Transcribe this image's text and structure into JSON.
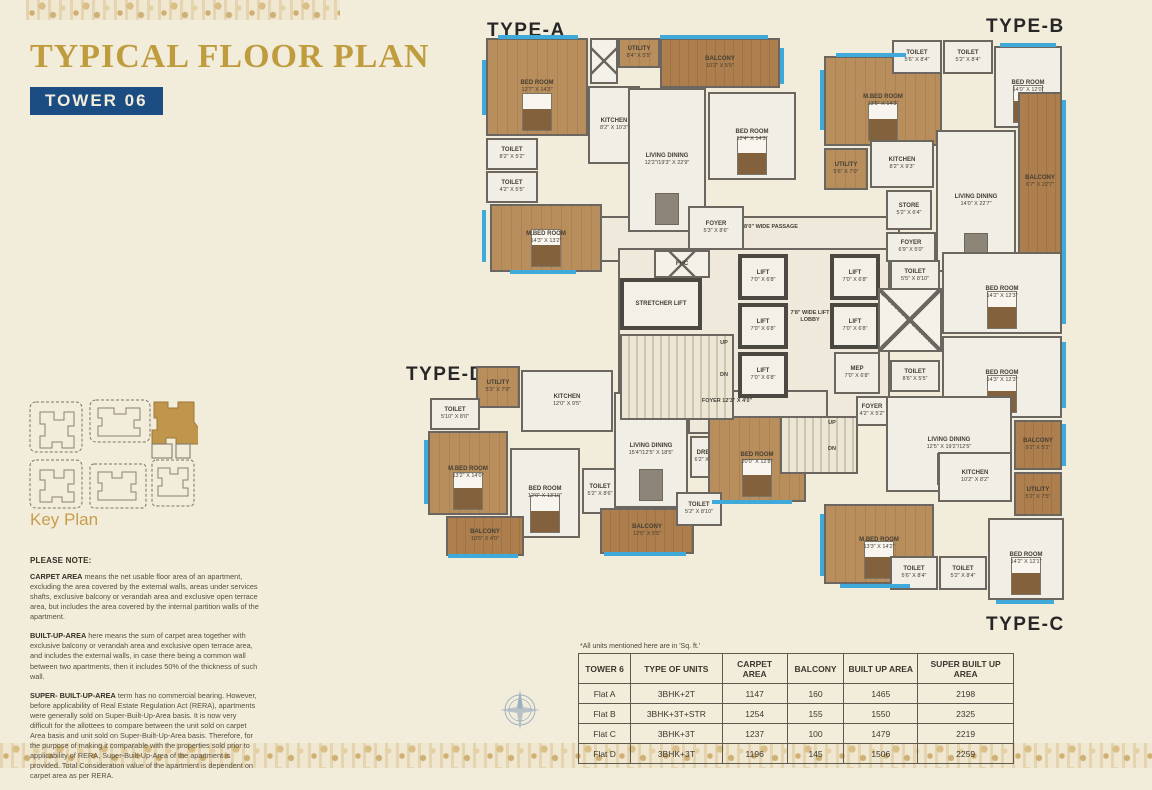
{
  "header": {
    "title": "TYPICAL FLOOR PLAN",
    "badge": "TOWER 06",
    "title_color": "#bf9c3e",
    "badge_bg": "#1c4d82"
  },
  "key_plan": {
    "label": "Key Plan",
    "highlight_color": "#c0954c"
  },
  "notes": {
    "heading": "PLEASE NOTE:",
    "paragraphs": [
      {
        "lead": "CARPET AREA",
        "text": " means the net usable floor area of an apartment, excluding the area covered by the external walls, areas under services shafts, exclusive balcony or verandah area and exclusive open terrace area, but includes the area covered by the internal partition walls of the apartment."
      },
      {
        "lead": "BUILT-UP-AREA",
        "text": " here means the sum of carpet area together with exclusive balcony or verandah area and exclusive open terrace area, and includes the external walls, in case there being a common wall between two apartments, then it includes 50% of the thickness of such wall."
      },
      {
        "lead": "SUPER- BUILT-UP-AREA",
        "text": " term has no commercial bearing. However, before applicability of Real Estate Regulation Act (RERA), apartments were generally sold on Super-Built-Up-Area basis. It is now very difficult for the allottees to compare between the unit sold on carpet Area basis and unit sold on Super-Built-Up-Area basis. Therefore, for the purpose of making it comparable with the properties sold prior to applicability of RERA, Super-Built-Up-Area of the apartment is provided. Total Consideration value of the apartment is dependent on carpet area as per RERA."
      }
    ]
  },
  "table": {
    "note": "*All units mentioned here are in 'Sq. ft.'",
    "headers": [
      "TOWER 6",
      "TYPE OF UNITS",
      "CARPET AREA",
      "BALCONY",
      "BUILT UP AREA",
      "SUPER BUILT UP AREA"
    ],
    "rows": [
      [
        "Flat A",
        "3BHK+2T",
        "1147",
        "160",
        "1465",
        "2198"
      ],
      [
        "Flat B",
        "3BHK+3T+STR",
        "1254",
        "155",
        "1550",
        "2325"
      ],
      [
        "Flat C",
        "3BHK+3T",
        "1237",
        "100",
        "1479",
        "2219"
      ],
      [
        "Flat D",
        "3BHK+3T",
        "1196",
        "145",
        "1506",
        "2259"
      ]
    ]
  },
  "floorplan": {
    "type_labels": [
      {
        "text": "TYPE-A",
        "x": 487,
        "y": 20
      },
      {
        "text": "TYPE-B",
        "x": 986,
        "y": 16
      },
      {
        "text": "TYPE-C",
        "x": 986,
        "y": 614
      },
      {
        "text": "TYPE-D",
        "x": 406,
        "y": 364
      }
    ],
    "rooms": [
      {
        "x": 600,
        "y": 216,
        "w": 300,
        "h": 46,
        "kind": "corr"
      },
      {
        "x": 618,
        "y": 248,
        "w": 272,
        "h": 176,
        "kind": "corr"
      },
      {
        "x": 688,
        "y": 390,
        "w": 140,
        "h": 44,
        "kind": "corr"
      },
      {
        "x": 486,
        "y": 38,
        "w": 102,
        "h": 98,
        "kind": "wood",
        "label": "BED ROOM",
        "size": "12'7\" X 14'3\"",
        "bed": 1
      },
      {
        "x": 590,
        "y": 38,
        "w": 28,
        "h": 46,
        "kind": "shaft"
      },
      {
        "x": 618,
        "y": 38,
        "w": 42,
        "h": 30,
        "kind": "wood",
        "label": "UTILITY",
        "size": "8'4\" X 5'5\""
      },
      {
        "x": 660,
        "y": 38,
        "w": 120,
        "h": 50,
        "kind": "balc",
        "label": "BALCONY",
        "size": "10'2\" X 5'5\""
      },
      {
        "x": 588,
        "y": 86,
        "w": 52,
        "h": 78,
        "kind": "tile",
        "label": "KITCHEN",
        "size": "8'2\" X 10'3\""
      },
      {
        "x": 486,
        "y": 138,
        "w": 52,
        "h": 32,
        "kind": "tile",
        "label": "TOILET",
        "size": "8'2\" X 5'2\""
      },
      {
        "x": 486,
        "y": 171,
        "w": 52,
        "h": 32,
        "kind": "tile",
        "label": "TOILET",
        "size": "4'2\" X 5'5\""
      },
      {
        "x": 490,
        "y": 204,
        "w": 112,
        "h": 68,
        "kind": "wood",
        "label": "M.BED ROOM",
        "size": "14'3\" X 13'2\"",
        "bed": 1
      },
      {
        "x": 628,
        "y": 88,
        "w": 78,
        "h": 144,
        "kind": "tile",
        "label": "LIVING DINING",
        "size": "12'2\"/19'3\" X 22'9\"",
        "dtable": 1
      },
      {
        "x": 708,
        "y": 92,
        "w": 88,
        "h": 88,
        "kind": "tile",
        "label": "BED ROOM",
        "size": "12'4\" X 14'3\"",
        "bed": 1
      },
      {
        "x": 688,
        "y": 206,
        "w": 56,
        "h": 44,
        "kind": "tile",
        "label": "FOYER",
        "size": "5'3\" X 8'6\""
      },
      {
        "x": 824,
        "y": 56,
        "w": 118,
        "h": 90,
        "kind": "wood",
        "label": "M.BED ROOM",
        "size": "13'5\" X 14'3\"",
        "bed": 1
      },
      {
        "x": 892,
        "y": 40,
        "w": 50,
        "h": 34,
        "kind": "tile",
        "label": "TOILET",
        "size": "5'6\" X 8'4\""
      },
      {
        "x": 943,
        "y": 40,
        "w": 50,
        "h": 34,
        "kind": "tile",
        "label": "TOILET",
        "size": "5'2\" X 8'4\""
      },
      {
        "x": 994,
        "y": 46,
        "w": 68,
        "h": 82,
        "kind": "tile",
        "label": "BED ROOM",
        "size": "14'0\" X 12'0\"",
        "bed": 1
      },
      {
        "x": 824,
        "y": 148,
        "w": 44,
        "h": 42,
        "kind": "wood",
        "label": "UTILITY",
        "size": "5'6\" X 7'0\""
      },
      {
        "x": 870,
        "y": 140,
        "w": 64,
        "h": 48,
        "kind": "tile",
        "label": "KITCHEN",
        "size": "8'2\" X 9'3\""
      },
      {
        "x": 936,
        "y": 130,
        "w": 80,
        "h": 142,
        "kind": "tile",
        "label": "LIVING DINING",
        "size": "14'0\" X 22'7\"",
        "dtable": 1
      },
      {
        "x": 886,
        "y": 190,
        "w": 46,
        "h": 40,
        "kind": "tile",
        "label": "STORE",
        "size": "5'2\" X 6'4\""
      },
      {
        "x": 1018,
        "y": 92,
        "w": 44,
        "h": 180,
        "kind": "balc",
        "label": "BALCONY",
        "size": "6'7\" X 22'7\""
      },
      {
        "x": 886,
        "y": 232,
        "w": 50,
        "h": 30,
        "kind": "tile",
        "label": "FOYER",
        "size": "6'9\" X 5'0\""
      },
      {
        "x": 890,
        "y": 260,
        "w": 50,
        "h": 32,
        "kind": "tile",
        "label": "TOILET",
        "size": "5'5\" X 8'10\""
      },
      {
        "x": 942,
        "y": 252,
        "w": 120,
        "h": 82,
        "kind": "tile",
        "label": "BED ROOM",
        "size": "14'2\" X 12'3\"",
        "bed": 1
      },
      {
        "x": 890,
        "y": 360,
        "w": 50,
        "h": 32,
        "kind": "tile",
        "label": "TOILET",
        "size": "8'6\" X 5'5\""
      },
      {
        "x": 942,
        "y": 336,
        "w": 120,
        "h": 82,
        "kind": "tile",
        "label": "BED ROOM",
        "size": "14'3\" X 12'3\"",
        "bed": 1
      },
      {
        "x": 1014,
        "y": 420,
        "w": 48,
        "h": 50,
        "kind": "balc",
        "label": "BALCONY",
        "size": "9'2\" X 5'2\""
      },
      {
        "x": 886,
        "y": 396,
        "w": 126,
        "h": 96,
        "kind": "tile",
        "label": "LIVING DINING",
        "size": "12'5\" X 19'2\"/12'5\"",
        "dtable": 1
      },
      {
        "x": 938,
        "y": 452,
        "w": 74,
        "h": 50,
        "kind": "tile",
        "label": "KITCHEN",
        "size": "10'2\" X 8'2\""
      },
      {
        "x": 1014,
        "y": 472,
        "w": 48,
        "h": 44,
        "kind": "balc",
        "label": "UTILITY",
        "size": "5'2\" X 7'5\""
      },
      {
        "x": 824,
        "y": 504,
        "w": 110,
        "h": 80,
        "kind": "wood",
        "label": "M.BED ROOM",
        "size": "13'3\" X 14'2\"",
        "bed": 1
      },
      {
        "x": 890,
        "y": 556,
        "w": 48,
        "h": 34,
        "kind": "tile",
        "label": "TOILET",
        "size": "5'6\" X 8'4\""
      },
      {
        "x": 939,
        "y": 556,
        "w": 48,
        "h": 34,
        "kind": "tile",
        "label": "TOILET",
        "size": "5'2\" X 8'4\""
      },
      {
        "x": 988,
        "y": 518,
        "w": 76,
        "h": 82,
        "kind": "tile",
        "label": "BED ROOM",
        "size": "14'2\" X 12'1\"",
        "bed": 1
      },
      {
        "x": 856,
        "y": 396,
        "w": 32,
        "h": 30,
        "kind": "tile",
        "label": "FOYER",
        "size": "4'2\" X 5'2\""
      },
      {
        "x": 476,
        "y": 366,
        "w": 44,
        "h": 42,
        "kind": "wood",
        "label": "UTILITY",
        "size": "5'3\" X 7'0\""
      },
      {
        "x": 521,
        "y": 370,
        "w": 92,
        "h": 62,
        "kind": "tile",
        "label": "KITCHEN",
        "size": "12'0\" X 9'5\""
      },
      {
        "x": 430,
        "y": 398,
        "w": 50,
        "h": 32,
        "kind": "tile",
        "label": "TOILET",
        "size": "5'10\" X 8'0\""
      },
      {
        "x": 428,
        "y": 431,
        "w": 80,
        "h": 84,
        "kind": "wood",
        "label": "M.BED ROOM",
        "size": "13'2\" X 14'0\"",
        "bed": 1
      },
      {
        "x": 510,
        "y": 448,
        "w": 70,
        "h": 90,
        "kind": "tile",
        "label": "BED ROOM",
        "size": "12'0\" X 13'10\"",
        "bed": 1
      },
      {
        "x": 582,
        "y": 468,
        "w": 36,
        "h": 46,
        "kind": "tile",
        "label": "TOILET",
        "size": "5'2\" X 8'6\""
      },
      {
        "x": 614,
        "y": 392,
        "w": 74,
        "h": 116,
        "kind": "tile",
        "label": "LIVING DINING",
        "size": "15'4\"/12'5\" X 18'5\"",
        "dtable": 1
      },
      {
        "x": 446,
        "y": 516,
        "w": 78,
        "h": 40,
        "kind": "balc",
        "label": "BALCONY",
        "size": "10'5\" X 4'0\""
      },
      {
        "x": 600,
        "y": 508,
        "w": 94,
        "h": 46,
        "kind": "balc",
        "label": "BALCONY",
        "size": "12'5\" X 5'5\""
      },
      {
        "x": 690,
        "y": 436,
        "w": 34,
        "h": 42,
        "kind": "tile",
        "label": "DRESS",
        "size": "6'2\" X 6'7\""
      },
      {
        "x": 708,
        "y": 416,
        "w": 98,
        "h": 86,
        "kind": "wood",
        "label": "BED ROOM",
        "size": "20'0\" X 12'8\"",
        "bed": 1
      },
      {
        "x": 676,
        "y": 492,
        "w": 46,
        "h": 34,
        "kind": "tile",
        "label": "TOILET",
        "size": "5'2\" X 8'10\""
      },
      {
        "x": 654,
        "y": 250,
        "w": 56,
        "h": 28,
        "kind": "shaft",
        "label": "FHC"
      },
      {
        "x": 620,
        "y": 278,
        "w": 82,
        "h": 52,
        "kind": "lift",
        "label": "STRETCHER LIFT"
      },
      {
        "x": 620,
        "y": 334,
        "w": 114,
        "h": 86,
        "kind": "stair"
      },
      {
        "x": 738,
        "y": 254,
        "w": 50,
        "h": 46,
        "kind": "lift",
        "label": "LIFT",
        "size": "7'0\" X 6'8\""
      },
      {
        "x": 738,
        "y": 303,
        "w": 50,
        "h": 46,
        "kind": "lift",
        "label": "LIFT",
        "size": "7'0\" X 6'8\""
      },
      {
        "x": 738,
        "y": 352,
        "w": 50,
        "h": 46,
        "kind": "lift",
        "label": "LIFT",
        "size": "7'0\" X 6'8\""
      },
      {
        "x": 830,
        "y": 254,
        "w": 50,
        "h": 46,
        "kind": "lift",
        "label": "LIFT",
        "size": "7'0\" X 6'8\""
      },
      {
        "x": 830,
        "y": 303,
        "w": 50,
        "h": 46,
        "kind": "lift",
        "label": "LIFT",
        "size": "7'0\" X 6'8\""
      },
      {
        "x": 834,
        "y": 352,
        "w": 46,
        "h": 42,
        "kind": "tile",
        "label": "MEP",
        "size": "7'0\" X 6'8\""
      },
      {
        "x": 878,
        "y": 288,
        "w": 64,
        "h": 64,
        "kind": "shaft"
      },
      {
        "x": 780,
        "y": 416,
        "w": 78,
        "h": 58,
        "kind": "stair"
      }
    ],
    "annotations": [
      {
        "text": "8'0\" WIDE PASSAGE",
        "x": 716,
        "y": 224,
        "w": 110
      },
      {
        "text": "7'8\" WIDE LIFT LOBBY",
        "x": 790,
        "y": 310,
        "w": 40
      },
      {
        "text": "FOYER 12'3\" X 4'0\"",
        "x": 692,
        "y": 398,
        "w": 70
      },
      {
        "text": "UP",
        "x": 716,
        "y": 340,
        "w": 16
      },
      {
        "text": "DN",
        "x": 716,
        "y": 372,
        "w": 16
      },
      {
        "text": "UP",
        "x": 824,
        "y": 420,
        "w": 16
      },
      {
        "text": "DN",
        "x": 824,
        "y": 446,
        "w": 16
      }
    ],
    "windows": [
      [
        498,
        35,
        80,
        4
      ],
      [
        660,
        35,
        108,
        4
      ],
      [
        482,
        60,
        4,
        55
      ],
      [
        482,
        210,
        4,
        52
      ],
      [
        510,
        270,
        66,
        4
      ],
      [
        780,
        48,
        4,
        36
      ],
      [
        836,
        53,
        70,
        4
      ],
      [
        1000,
        43,
        56,
        4
      ],
      [
        1062,
        100,
        4,
        160
      ],
      [
        820,
        70,
        4,
        60
      ],
      [
        1062,
        258,
        4,
        66
      ],
      [
        1062,
        342,
        4,
        66
      ],
      [
        1062,
        424,
        4,
        42
      ],
      [
        996,
        600,
        58,
        4
      ],
      [
        840,
        584,
        70,
        4
      ],
      [
        820,
        514,
        4,
        62
      ],
      [
        424,
        440,
        4,
        64
      ],
      [
        448,
        554,
        70,
        4
      ],
      [
        604,
        552,
        82,
        4
      ],
      [
        712,
        500,
        80,
        4
      ]
    ]
  }
}
